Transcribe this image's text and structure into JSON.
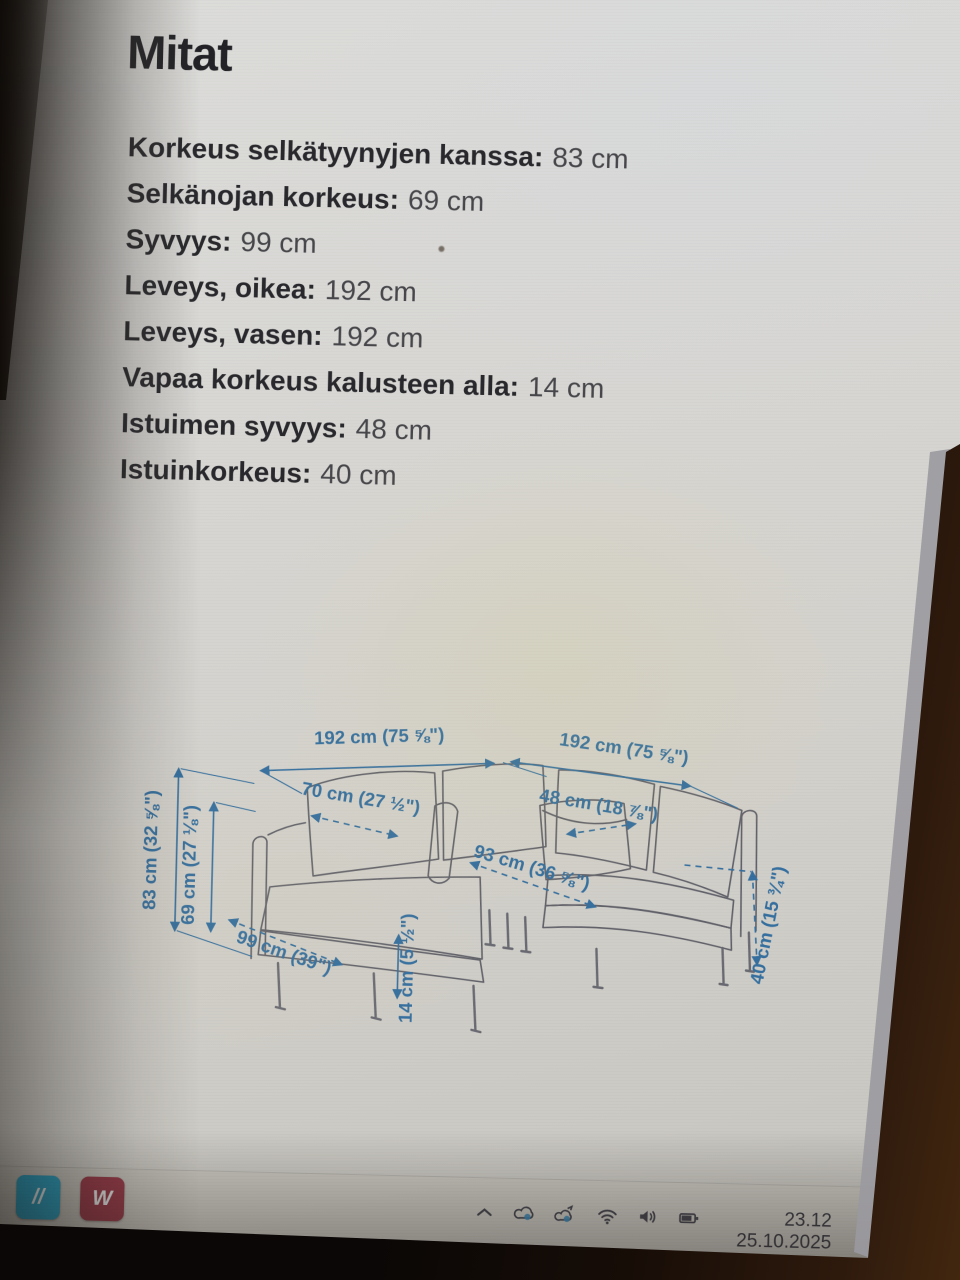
{
  "page": {
    "title": "Mitat"
  },
  "specs": [
    {
      "label": "Korkeus selkätyynyjen kanssa:",
      "value": "83 cm"
    },
    {
      "label": "Selkänojan korkeus:",
      "value": "69 cm"
    },
    {
      "label": "Syvyys:",
      "value": "99 cm"
    },
    {
      "label": "Leveys, oikea:",
      "value": "192 cm"
    },
    {
      "label": "Leveys, vasen:",
      "value": "192 cm"
    },
    {
      "label": "Vapaa korkeus kalusteen alla:",
      "value": "14 cm"
    },
    {
      "label": "Istuimen syvyys:",
      "value": "48 cm"
    },
    {
      "label": "Istuinkorkeus:",
      "value": "40 cm"
    }
  ],
  "diagram": {
    "accent_color": "#356f9f",
    "sketch_color": "#61616a",
    "labels": [
      {
        "id": "width-left",
        "text": "192 cm (75 ⅝\")",
        "x": 248,
        "y": 33,
        "rot": -3
      },
      {
        "id": "width-right",
        "text": "192 cm (75 ⅝\")",
        "x": 492,
        "y": 39,
        "rot": 7
      },
      {
        "id": "height-back-cushions",
        "text": "83 cm (32 ⅝\")",
        "x": 28,
        "y": 146,
        "rot": -90
      },
      {
        "id": "backrest-height",
        "text": "69 cm (27 ⅛\")",
        "x": 67,
        "y": 160,
        "rot": -90
      },
      {
        "id": "seat-width-left",
        "text": "70 cm (27 ½\")",
        "x": 230,
        "y": 95,
        "rot": 8
      },
      {
        "id": "seat-depth",
        "text": "48 cm (18 ⅞\")",
        "x": 468,
        "y": 96,
        "rot": 8
      },
      {
        "id": "depth",
        "text": "99 cm (39\")",
        "x": 156,
        "y": 251,
        "rot": 18
      },
      {
        "id": "floor-clearance",
        "text": "14 cm (5 ½\")",
        "x": 287,
        "y": 258,
        "rot": -90
      },
      {
        "id": "seat-width-right",
        "text": "93 cm (36 ⅝\")",
        "x": 402,
        "y": 160,
        "rot": 15
      },
      {
        "id": "seat-height",
        "text": "40 cm (15 ¾\")",
        "x": 647,
        "y": 207,
        "rot": -80
      }
    ]
  },
  "taskbar": {
    "apps": [
      {
        "id": "teal-app",
        "glyph": "//",
        "bg": "#2ba6c9"
      },
      {
        "id": "red-app",
        "glyph": "W",
        "bg": "#9d3c4b"
      }
    ],
    "tray_icons": [
      "chevron-up",
      "cloud",
      "cloud-sync",
      "wifi",
      "volume",
      "battery"
    ],
    "clock": {
      "time": "23.12",
      "date": "25.10.2025"
    }
  }
}
